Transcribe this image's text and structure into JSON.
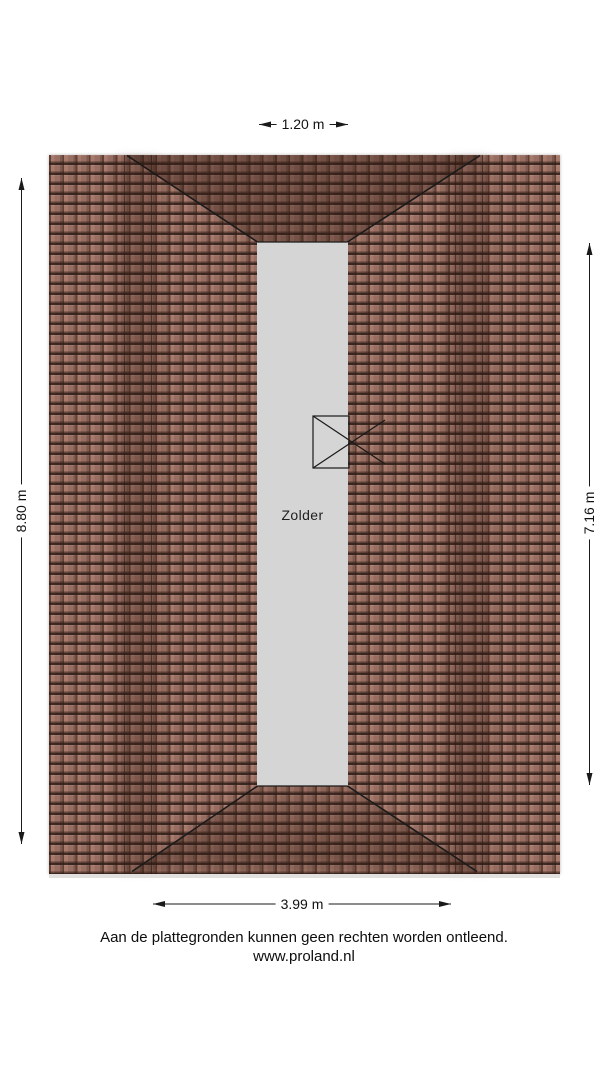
{
  "plan": {
    "room_label": "Zolder",
    "dimensions": {
      "top": "1.20 m",
      "bottom": "3.99 m",
      "left": "8.80 m",
      "right": "7.16 m"
    },
    "footer": {
      "disclaimer": "Aan de plattegronden kunnen geen rechten worden ontleend.",
      "website": "www.proland.nl"
    },
    "colors": {
      "tile_base": "#a87a6c",
      "tile_line": "#3a2620",
      "floor_fill": "#d5d5d5",
      "line": "#1a1a1a",
      "background": "#ffffff"
    }
  }
}
